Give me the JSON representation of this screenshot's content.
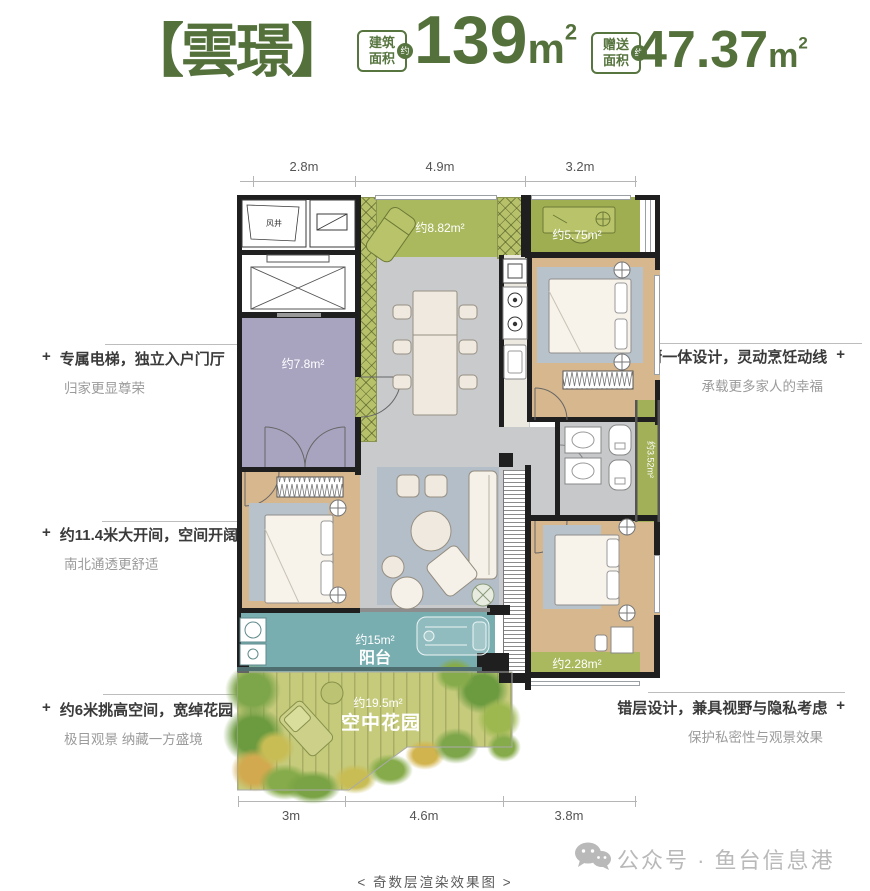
{
  "colors": {
    "brand_green": "#57753f",
    "olive": "#aab85e",
    "teal": "#79aeb1",
    "purple": "#a8a4c0",
    "wood": "#d7b78d"
  },
  "header": {
    "title": "【雲璟】",
    "metrics": [
      {
        "label_line1": "建筑",
        "label_line2": "面积",
        "badge": "约",
        "value": "139",
        "unit": "m",
        "sup": "2"
      },
      {
        "label_line1": "赠送",
        "label_line2": "面积",
        "badge": "约",
        "value": "47.37",
        "unit": "m",
        "sup": "2"
      }
    ]
  },
  "dimensions": {
    "top": [
      "2.8m",
      "4.9m",
      "3.2m"
    ],
    "bottom": [
      "3m",
      "4.6m",
      "3.8m"
    ]
  },
  "annotations": {
    "marker": "+",
    "left": [
      {
        "title": "专属电梯，独立入户门厅",
        "sub": "归家更显尊荣"
      },
      {
        "title": "约11.4米大开间，空间开阔",
        "sub": "南北通透更舒适"
      },
      {
        "title": "约6米挑高空间，宽绰花园",
        "sub": "极目观景  纳藏一方盛境"
      }
    ],
    "right": [
      {
        "title": "餐厨一体设计，灵动烹饪动线",
        "sub": "承载更多家人的幸福"
      },
      {
        "title": "错层设计，兼具视野与隐私考虑",
        "sub": "保护私密性与观景效果"
      }
    ]
  },
  "plan": {
    "labels": {
      "shaft": "风井",
      "foyer": "约7.8m²",
      "top_terrace": "约8.82m²",
      "study": "约5.75m²",
      "side_terrace": "约3.52m²",
      "bed2_bay": "约2.28m²",
      "balcony_area": "约15m²",
      "balcony": "阳台",
      "garden_area": "约19.5m²",
      "garden": "空中花园"
    }
  },
  "footer": {
    "caption": "< 奇数层渲染效果图 >",
    "watermark": "公众号 · 鱼台信息港"
  }
}
